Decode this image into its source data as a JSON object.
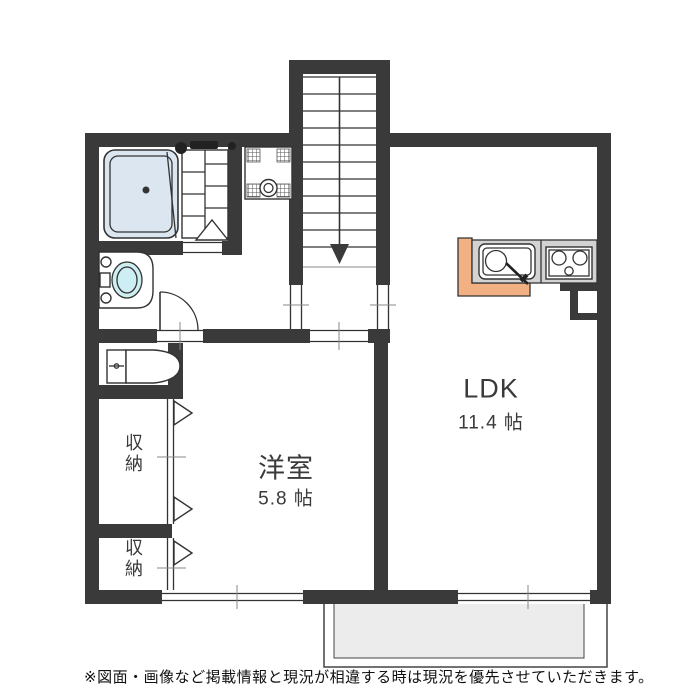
{
  "floor_plan": {
    "title": "apartment-floor-plan",
    "rooms": {
      "ldk": {
        "name": "LDK",
        "size": "11.4 帖"
      },
      "western_room": {
        "name": "洋室",
        "size": "5.8 帖"
      },
      "storage_upper": {
        "name": "収納"
      },
      "storage_lower": {
        "name": "収納"
      }
    },
    "fixtures": [
      "bathtub",
      "bath-folding-door",
      "washing-machine-pan",
      "washbasin",
      "toilet",
      "hinged-door",
      "staircase-down",
      "kitchen-sink",
      "gas-stove-3-burner",
      "closet-bifold-doors",
      "sliding-windows",
      "balcony",
      "pipe-space"
    ],
    "stair_direction": "down",
    "disclaimer": "※図面・画像など掲載情報と現況が相違する時は現況を優先させていただきます。",
    "colors": {
      "wall": "#3a3a3a",
      "line": "#333333",
      "bathtub_fill": "#dce6f0",
      "basin_fill": "#cdeef3",
      "counter_orange": "#f2b183",
      "counter_gray": "#d3d3d3",
      "balcony_fill": "#ececec"
    }
  }
}
